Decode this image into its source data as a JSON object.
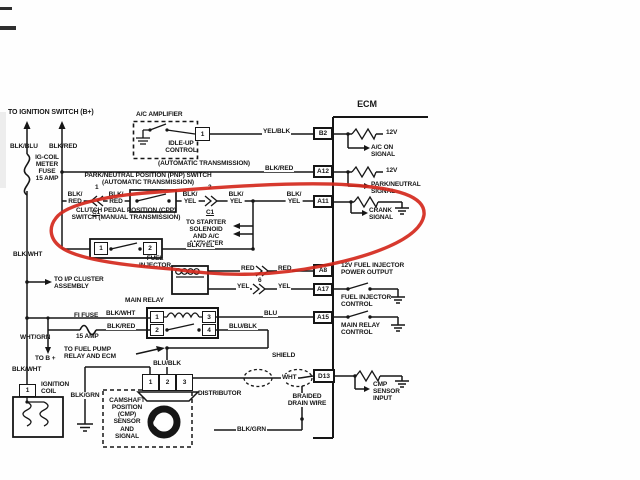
{
  "diagram": {
    "title": "ECM",
    "type": "automotive wiring diagram",
    "annotation_color": "#d4281c",
    "wire_color": "#161616"
  },
  "labels": [
    {
      "id": "to-ignition-switch-label",
      "t": "TO IGNITION SWITCH (B+)",
      "x": 8,
      "y": 109,
      "fs": 7
    },
    {
      "id": "blk-blu-label",
      "t": "BLK/BLU",
      "x": 10,
      "y": 143
    },
    {
      "id": "blk-red-top-label",
      "t": "BLK/RED",
      "x": 49,
      "y": 143
    },
    {
      "id": "ig-coil-fuse-label",
      "t": "IG-COIL\nMETER\nFUSE\n15 AMP",
      "x": 47,
      "y": 154,
      "al": "c"
    },
    {
      "id": "ac-amplifier-label",
      "t": "A/C AMPLIFIER",
      "x": 136,
      "y": 111
    },
    {
      "id": "idle-up-control-label",
      "t": "IDLE-UP\nCONTROL",
      "x": 181,
      "y": 140,
      "al": "c"
    },
    {
      "id": "yel-blk-label",
      "t": "YEL/BLK",
      "x": 262,
      "y": 128,
      "bg": 1
    },
    {
      "id": "automatic-transmission-label",
      "t": "(AUTOMATIC TRANSMISSION)",
      "x": 158,
      "y": 160
    },
    {
      "id": "blk-red-a12-label",
      "t": "BLK/RED",
      "x": 264,
      "y": 165,
      "bg": 1
    },
    {
      "id": "ecm-label",
      "t": "ECM",
      "x": 367,
      "y": 100,
      "fs": 9,
      "al": "c"
    },
    {
      "id": "pnp-switch-label",
      "t": "PARK/NEUTRAL POSITION (PNP) SWITCH\n(AUTOMATIC TRANSMISSION)",
      "x": 148,
      "y": 172,
      "al": "c"
    },
    {
      "id": "blk-red-pnp-left-label",
      "t": "BLK/\nRED",
      "x": 75,
      "y": 191,
      "al": "c",
      "bg": 1
    },
    {
      "id": "pin-1-pnp-label",
      "t": "1",
      "x": 95,
      "y": 184
    },
    {
      "id": "c1-left-label",
      "t": "C1",
      "x": 96,
      "y": 209,
      "al": "c",
      "u": 1
    },
    {
      "id": "blk-red-pnp-right-label",
      "t": "BLK/\nRED",
      "x": 116,
      "y": 191,
      "al": "c",
      "bg": 1
    },
    {
      "id": "blk-yel-pnp-left-label",
      "t": "BLK/\nYEL",
      "x": 190,
      "y": 191,
      "al": "c",
      "bg": 1
    },
    {
      "id": "pin-2-pnp-label",
      "t": "2",
      "x": 208,
      "y": 184
    },
    {
      "id": "c1-right-label",
      "t": "C1",
      "x": 210,
      "y": 209,
      "al": "c",
      "u": 1
    },
    {
      "id": "blk-yel-pnp-right-label",
      "t": "BLK/\nYEL",
      "x": 236,
      "y": 191,
      "al": "c",
      "bg": 1
    },
    {
      "id": "blk-yel-a11-label",
      "t": "BLK/\nYEL",
      "x": 294,
      "y": 191,
      "al": "c",
      "bg": 1
    },
    {
      "id": "to-starter-label",
      "t": "TO STARTER\nSOLENOID\nAND A/C\nAMPLIFIER",
      "x": 206,
      "y": 219,
      "al": "c"
    },
    {
      "id": "cpp-switch-label",
      "t": "CLUTCH PEDAL POSITION (CPP)\nSWITCH (MANUAL TRANSMISSION)",
      "x": 126,
      "y": 207,
      "al": "c"
    },
    {
      "id": "blk-yel-cpp-label",
      "t": "BLK/YEL",
      "x": 186,
      "y": 242,
      "bg": 1
    },
    {
      "id": "blk-wht-left-label",
      "t": "BLK/WHT",
      "x": 13,
      "y": 251
    },
    {
      "id": "to-ip-cluster-label",
      "t": "TO I/P CLUSTER\nASSEMBLY",
      "x": 54,
      "y": 276
    },
    {
      "id": "fuel-injector-label",
      "t": "FUEL\nINJECTOR",
      "x": 155,
      "y": 255,
      "al": "c"
    },
    {
      "id": "red-wire-label-1",
      "t": "RED",
      "x": 240,
      "y": 265,
      "bg": 1
    },
    {
      "id": "red-wire-label-2",
      "t": "RED",
      "x": 277,
      "y": 265,
      "bg": 1
    },
    {
      "id": "pin-6-label",
      "t": "6",
      "x": 258,
      "y": 277
    },
    {
      "id": "yel-wire-label-1",
      "t": "YEL",
      "x": 236,
      "y": 283,
      "bg": 1
    },
    {
      "id": "yel-wire-label-2",
      "t": "YEL",
      "x": 277,
      "y": 283,
      "bg": 1
    },
    {
      "id": "main-relay-label",
      "t": "MAIN RELAY",
      "x": 125,
      "y": 297
    },
    {
      "id": "fi-fuse-label",
      "t": "FI FUSE",
      "x": 74,
      "y": 312
    },
    {
      "id": "fi-fuse-amp-label",
      "t": "15 AMP",
      "x": 76,
      "y": 333
    },
    {
      "id": "blk-wht-relay-label",
      "t": "BLK/WHT",
      "x": 105,
      "y": 310,
      "bg": 1
    },
    {
      "id": "blk-red-relay-label",
      "t": "BLK/RED",
      "x": 106,
      "y": 323,
      "bg": 1
    },
    {
      "id": "wht-grn-label",
      "t": "WHT/GRN",
      "x": 20,
      "y": 334
    },
    {
      "id": "to-b-plus-label",
      "t": "TO B +",
      "x": 35,
      "y": 355
    },
    {
      "id": "to-fuel-pump-label",
      "t": "TO FUEL PUMP\nRELAY AND ECM",
      "x": 64,
      "y": 346
    },
    {
      "id": "blu-blk-relay-label",
      "t": "BLU/BLK",
      "x": 228,
      "y": 323,
      "bg": 1
    },
    {
      "id": "blu-a15-label",
      "t": "BLU",
      "x": 263,
      "y": 310,
      "bg": 1
    },
    {
      "id": "blu-blk-dist-label",
      "t": "BLU/BLK",
      "x": 167,
      "y": 360,
      "al": "c",
      "bg": 1
    },
    {
      "id": "blk-wht-coil-label",
      "t": "BLK/WHT",
      "x": 12,
      "y": 366
    },
    {
      "id": "ignition-coil-label",
      "t": "IGNITION\nCOIL",
      "x": 41,
      "y": 381
    },
    {
      "id": "blk-grn-dist-label",
      "t": "BLK/GRN",
      "x": 85,
      "y": 392,
      "al": "c",
      "bg": 1
    },
    {
      "id": "distributor-label",
      "t": "DISTRIBUTOR",
      "x": 198,
      "y": 390
    },
    {
      "id": "cmp-sensor-label",
      "t": "CAMSHAFT\nPOSITION\n(CMP)\nSENSOR\nAND\nSIGNAL",
      "x": 127,
      "y": 397,
      "al": "c"
    },
    {
      "id": "shield-label",
      "t": "SHIELD",
      "x": 272,
      "y": 352
    },
    {
      "id": "wht-label",
      "t": "WHT",
      "x": 281,
      "y": 374,
      "bg": 1
    },
    {
      "id": "braided-drain-label",
      "t": "BRAIDED\nDRAIN WIRE",
      "x": 307,
      "y": 393,
      "al": "c",
      "bg": 1
    },
    {
      "id": "blk-grn-bottom-label",
      "t": "BLK/GRN",
      "x": 236,
      "y": 426,
      "bg": 1
    },
    {
      "id": "12v-b2-label",
      "t": "12V",
      "x": 386,
      "y": 129
    },
    {
      "id": "ac-on-signal-label",
      "t": "A/C ON\nSIGNAL",
      "x": 371,
      "y": 144
    },
    {
      "id": "12v-a12-label",
      "t": "12V",
      "x": 386,
      "y": 167
    },
    {
      "id": "park-neutral-signal-label",
      "t": "PARK/NEUTRAL\nSIGNAL",
      "x": 371,
      "y": 181
    },
    {
      "id": "crank-signal-label",
      "t": "CRANK\nSIGNAL",
      "x": 369,
      "y": 207
    },
    {
      "id": "fuel-inj-power-label",
      "t": "12V FUEL INJECTOR\nPOWER OUTPUT",
      "x": 341,
      "y": 262
    },
    {
      "id": "fuel-inj-control-label",
      "t": "FUEL INJECTOR\nCONTROL",
      "x": 341,
      "y": 294
    },
    {
      "id": "main-relay-control-label",
      "t": "MAIN RELAY\nCONTROL",
      "x": 341,
      "y": 322
    },
    {
      "id": "cmp-sensor-input-label",
      "t": "CMP\nSENSOR\nINPUT",
      "x": 373,
      "y": 381
    }
  ],
  "boxes": [
    {
      "id": "acamp-pin-1",
      "t": "1",
      "x": 195,
      "y": 127,
      "w": 15,
      "h": 14
    },
    {
      "id": "ecm-terminal-b2",
      "t": "B2",
      "x": 313,
      "y": 127,
      "w": 20,
      "h": 13,
      "bold": 1
    },
    {
      "id": "ecm-terminal-a12",
      "t": "A12",
      "x": 313,
      "y": 165,
      "w": 20,
      "h": 13,
      "bold": 1
    },
    {
      "id": "ecm-terminal-a11",
      "t": "A11",
      "x": 313,
      "y": 195,
      "w": 20,
      "h": 13,
      "bold": 1
    },
    {
      "id": "ecm-terminal-a8",
      "t": "A8",
      "x": 313,
      "y": 264,
      "w": 20,
      "h": 13,
      "bold": 1
    },
    {
      "id": "ecm-terminal-a17",
      "t": "A17",
      "x": 313,
      "y": 283,
      "w": 20,
      "h": 13,
      "bold": 1
    },
    {
      "id": "ecm-terminal-a15",
      "t": "A15",
      "x": 313,
      "y": 311,
      "w": 20,
      "h": 13,
      "bold": 1
    },
    {
      "id": "ecm-terminal-d13",
      "t": "D13",
      "x": 313,
      "y": 369,
      "w": 22,
      "h": 14,
      "bold": 1
    },
    {
      "id": "relay-pin-1",
      "t": "1",
      "x": 150,
      "y": 311,
      "w": 14,
      "h": 12
    },
    {
      "id": "relay-pin-3",
      "t": "3",
      "x": 202,
      "y": 311,
      "w": 14,
      "h": 12
    },
    {
      "id": "relay-pin-2",
      "t": "2",
      "x": 150,
      "y": 324,
      "w": 14,
      "h": 12
    },
    {
      "id": "relay-pin-4",
      "t": "4",
      "x": 202,
      "y": 324,
      "w": 14,
      "h": 12
    },
    {
      "id": "cpp-pin-1",
      "t": "1",
      "x": 94,
      "y": 242,
      "w": 14,
      "h": 13
    },
    {
      "id": "cpp-pin-2",
      "t": "2",
      "x": 143,
      "y": 242,
      "w": 14,
      "h": 13
    },
    {
      "id": "dist-pin-1",
      "t": "1",
      "x": 142,
      "y": 374,
      "w": 17,
      "h": 17
    },
    {
      "id": "dist-pin-2",
      "t": "2",
      "x": 159,
      "y": 374,
      "w": 17,
      "h": 17
    },
    {
      "id": "dist-pin-3",
      "t": "3",
      "x": 176,
      "y": 374,
      "w": 17,
      "h": 17
    },
    {
      "id": "coil-pin-1",
      "t": "1",
      "x": 19,
      "y": 384,
      "w": 17,
      "h": 13
    }
  ]
}
